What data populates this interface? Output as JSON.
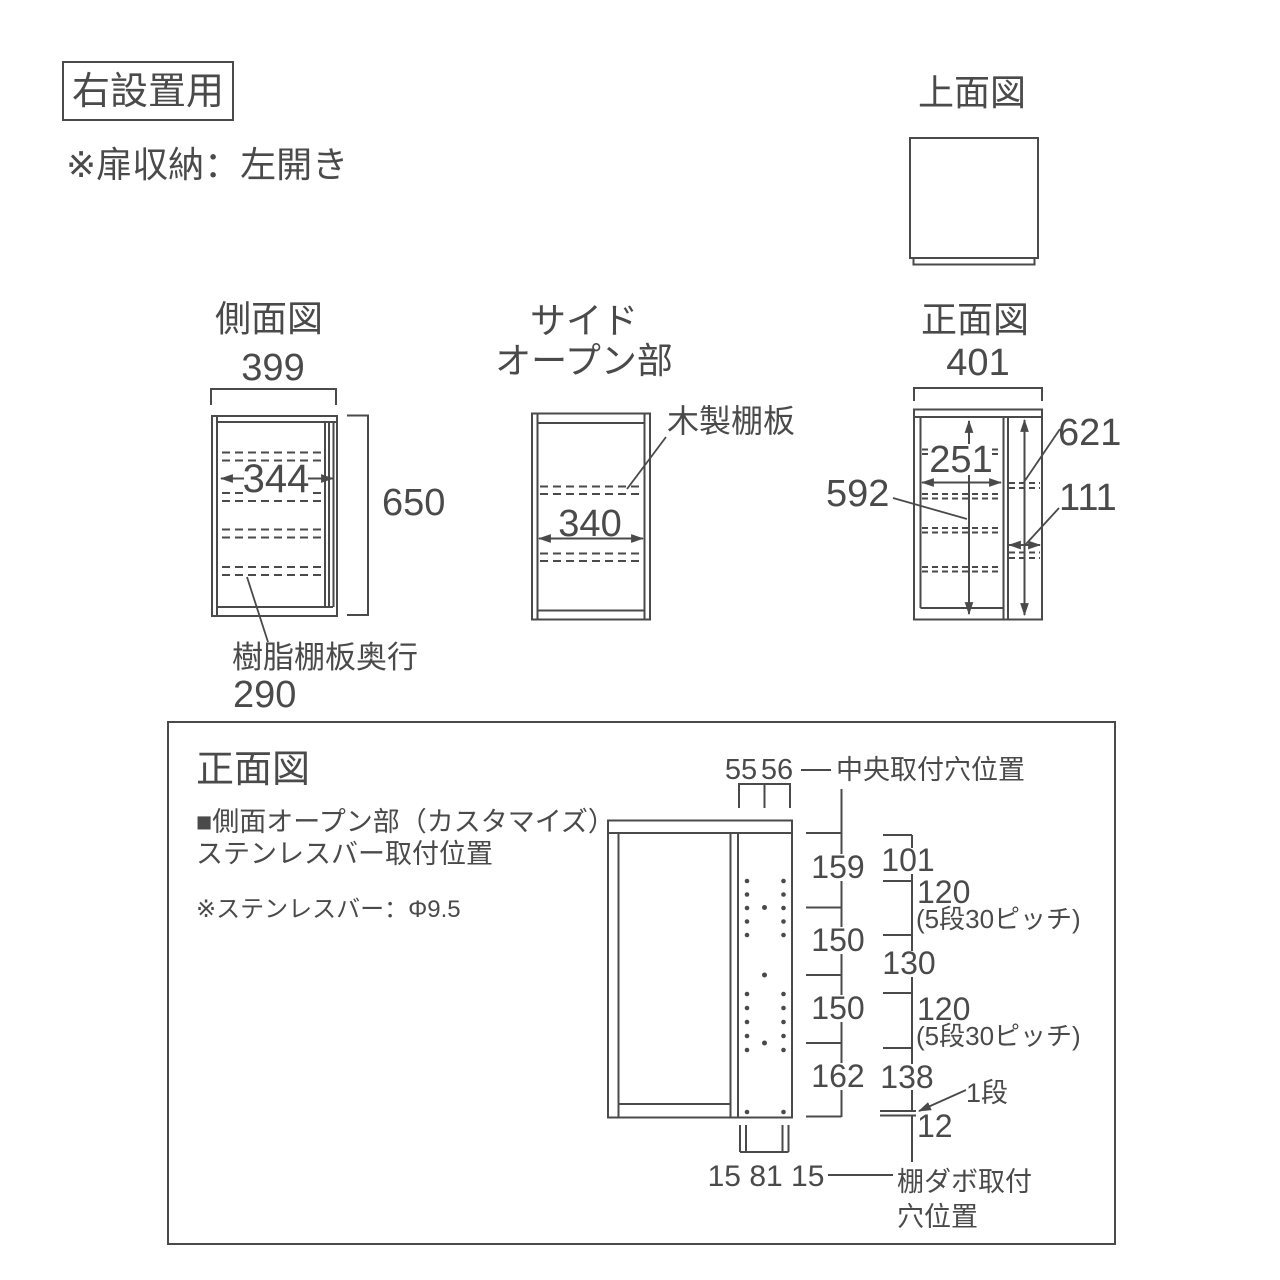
{
  "colors": {
    "line": "#4a4a4a",
    "background": "#ffffff"
  },
  "header": {
    "badge": "右設置用",
    "note": "※扉収納：左開き"
  },
  "top_view": {
    "title": "上面図"
  },
  "side_view": {
    "title": "側面図",
    "dim_width_top": "399",
    "dim_width_inner": "344",
    "dim_height": "650",
    "shelf_depth_label": "樹脂棚板奥行",
    "shelf_depth_value": "290"
  },
  "side_open_view": {
    "title_line1": "サイド",
    "title_line2": "オープン部",
    "dim_width": "340",
    "wood_shelf_label": "木製棚板"
  },
  "front_view": {
    "title": "正面図",
    "dim_width_top": "401",
    "dim_main_height": "592",
    "dim_main_width": "251",
    "dim_side_height": "621",
    "dim_side_width": "111"
  },
  "detail_panel": {
    "title": "正面図",
    "subtitle_line1": "■側面オープン部（カスタマイズ）",
    "subtitle_line2": "ステンレスバー取付位置",
    "note": "※ステンレスバー：Φ9.5",
    "top_dim_left": "55",
    "top_dim_right": "56",
    "center_hole_label": "中央取付穴位置",
    "left_chain": [
      "159",
      "150",
      "150",
      "162"
    ],
    "right_chain": {
      "d1": "101",
      "d2": "120",
      "d2_note": "(5段30ピッチ)",
      "d3": "130",
      "d4": "120",
      "d4_note": "(5段30ピッチ)",
      "d5": "138",
      "d6": "12"
    },
    "step_label": "1段",
    "bottom_dims": "15 81 15",
    "dabo_label_line1": "棚ダボ取付",
    "dabo_label_line2": "穴位置"
  }
}
